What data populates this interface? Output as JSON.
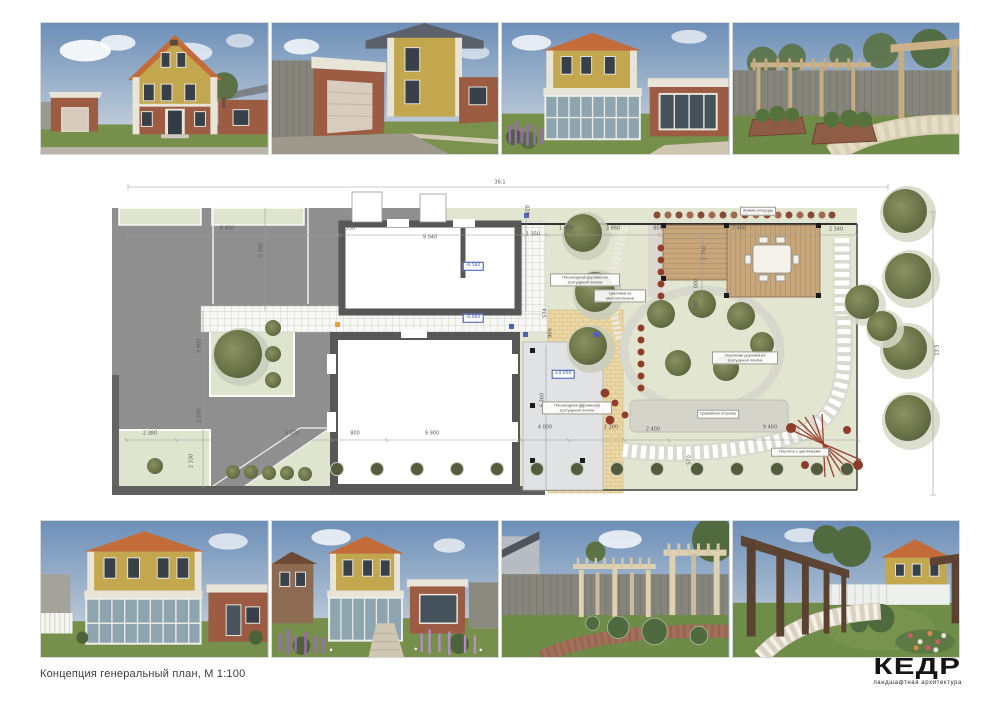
{
  "caption": "Концепция генеральный план, М 1:100",
  "logo": {
    "name": "КЕДР",
    "tagline": "ландшафтная архитектура"
  },
  "plan": {
    "dims": [
      "36.1",
      "13.5",
      "8 450",
      "1 550",
      "9 040",
      "1 350",
      "1 600",
      "3 860",
      "800",
      "7 400",
      "2 340",
      "2 750",
      "1 000",
      "600",
      "610",
      "4 640",
      "5 390",
      "3 900",
      "2 500",
      "2 330",
      "2 380",
      "6 070",
      "800",
      "9 900",
      "4 000",
      "1 200",
      "2 400",
      "9 400",
      "6 360",
      "920",
      "570",
      "574",
      "900"
    ],
    "levels": {
      "garage": "-0.560",
      "path": "-0.060",
      "terrace": "±0.000"
    },
    "labels": {
      "hedge": "Живая изгородь",
      "walk_top": "Пешеходная дорожка из тротуарной плитки",
      "flowers": "Цветники из многолетников",
      "main_path": "Основная дорожка из тротуарной плитки",
      "walk_bottom": "Пешеходная дорожка из тротуарной плитки",
      "gravel": "Гравийная отсыпка",
      "pergola": "Пергола с цветниками"
    }
  },
  "renders": {
    "top": [
      {
        "name": "house-front-view"
      },
      {
        "name": "garage-entrance-view"
      },
      {
        "name": "rear-facade-conservatory"
      },
      {
        "name": "garden-pergola-walk"
      }
    ],
    "bottom": [
      {
        "name": "rear-elevation-veranda"
      },
      {
        "name": "veranda-flowerbeds-view"
      },
      {
        "name": "lawn-pergolas-view"
      },
      {
        "name": "pergola-alley-path"
      }
    ]
  }
}
